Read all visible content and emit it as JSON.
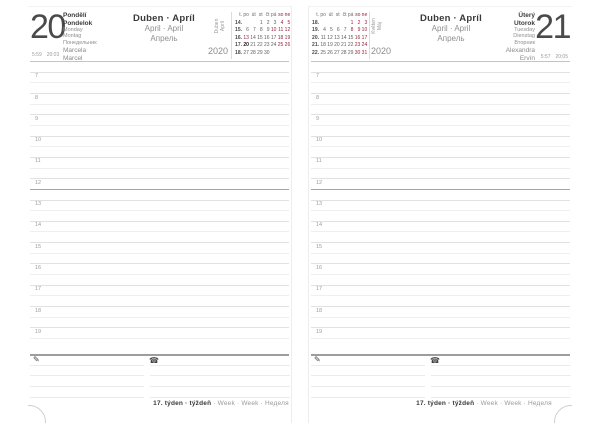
{
  "spread": {
    "week_footer": {
      "bold": "17. týden · týždeň",
      "rest": " · Week · Week · Неделя"
    },
    "month_header": {
      "line1": "Duben · Apríl",
      "line2": "April · April",
      "line3": "Апрель"
    },
    "year": "2020",
    "calendar_day_header": [
      "t.",
      "po",
      "út",
      "st",
      "čt",
      "pá",
      "so",
      "ne"
    ],
    "hours": [
      "7",
      "8",
      "9",
      "10",
      "11",
      "12",
      "13",
      "14",
      "15",
      "16",
      "17",
      "18",
      "19"
    ],
    "icons": {
      "pencil": "✎",
      "phone": "☎"
    },
    "colors": {
      "holiday_red": "#992138",
      "text_dark": "#3d3d3d",
      "text_gray": "#8f8f8f"
    }
  },
  "pages": [
    {
      "id": "left",
      "day_number": "20",
      "sunrise": "5:59",
      "sunset": "20:03",
      "day_names_primary": [
        "Pondělí",
        "Pondelok"
      ],
      "day_names_secondary": [
        "Monday",
        "Montag",
        "Понедельник"
      ],
      "name_days": [
        "Marcela",
        "Marcel"
      ],
      "mini_calendar": {
        "month_vertical": [
          "Duben",
          "Apríl"
        ],
        "weeks": [
          {
            "week": "14.",
            "days": [
              "",
              "",
              "1",
              "2",
              "3",
              "4",
              "5"
            ]
          },
          {
            "week": "15.",
            "days": [
              "6",
              "7",
              "8",
              "9",
              "10",
              "11",
              "12"
            ]
          },
          {
            "week": "16.",
            "days": [
              "13",
              "14",
              "15",
              "16",
              "17",
              "18",
              "19"
            ]
          },
          {
            "week": "17.",
            "days": [
              "20",
              "21",
              "22",
              "23",
              "24",
              "25",
              "26"
            ]
          },
          {
            "week": "18.",
            "days": [
              "27",
              "28",
              "29",
              "30",
              "",
              "",
              ""
            ]
          }
        ],
        "red_days": [
          "4",
          "5",
          "10",
          "11",
          "12",
          "13",
          "18",
          "19",
          "25",
          "26"
        ],
        "today": "20"
      }
    },
    {
      "id": "right",
      "day_number": "21",
      "sunrise": "5:57",
      "sunset": "20:05",
      "day_names_primary": [
        "Úterý",
        "Utorok"
      ],
      "day_names_secondary": [
        "Tuesday",
        "Dienstag",
        "Вторник"
      ],
      "name_days": [
        "Alexandra",
        "Ervín"
      ],
      "mini_calendar": {
        "month_vertical": [
          "Květen",
          "Máj"
        ],
        "weeks": [
          {
            "week": "18.",
            "days": [
              "",
              "",
              "",
              "",
              "1",
              "2",
              "3"
            ]
          },
          {
            "week": "19.",
            "days": [
              "4",
              "5",
              "6",
              "7",
              "8",
              "9",
              "10"
            ]
          },
          {
            "week": "20.",
            "days": [
              "11",
              "12",
              "13",
              "14",
              "15",
              "16",
              "17"
            ]
          },
          {
            "week": "21.",
            "days": [
              "18",
              "19",
              "20",
              "21",
              "22",
              "23",
              "24"
            ]
          },
          {
            "week": "22.",
            "days": [
              "25",
              "26",
              "27",
              "28",
              "29",
              "30",
              "31"
            ]
          }
        ],
        "red_days": [
          "1",
          "2",
          "3",
          "8",
          "9",
          "10",
          "16",
          "17",
          "23",
          "24",
          "30",
          "31"
        ],
        "today": ""
      }
    }
  ]
}
